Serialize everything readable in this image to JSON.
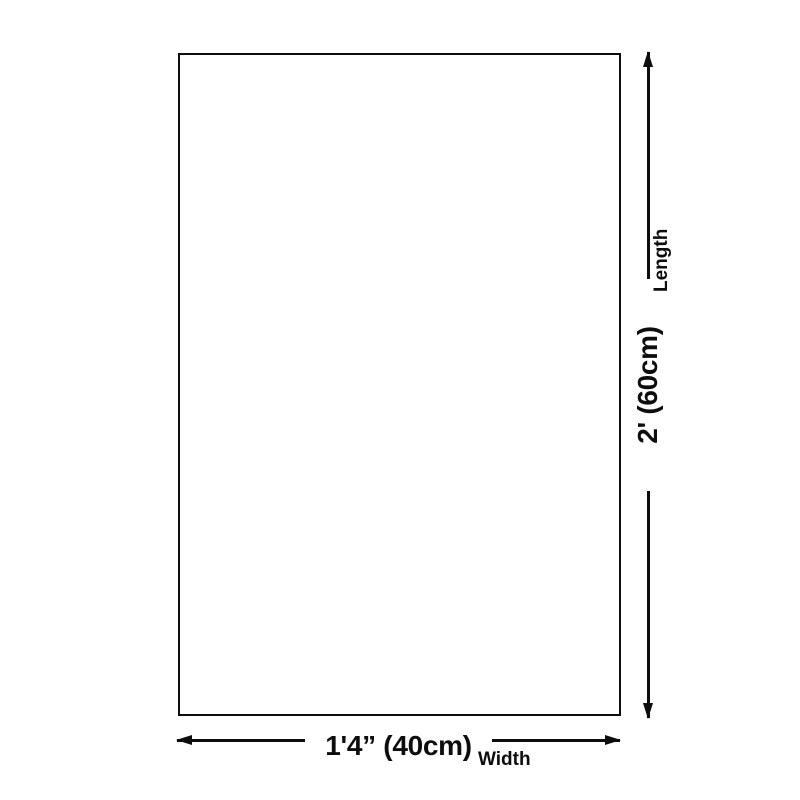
{
  "page": {
    "background_color": "#ffffff",
    "line_color": "#0d0d0d"
  },
  "diagram": {
    "shape": "blank-rectangle-product-outline",
    "length_dimension": {
      "value": "2' (60cm)",
      "label": "Length"
    },
    "width_dimension": {
      "value": "1'4” (40cm)",
      "label": "Width"
    }
  }
}
